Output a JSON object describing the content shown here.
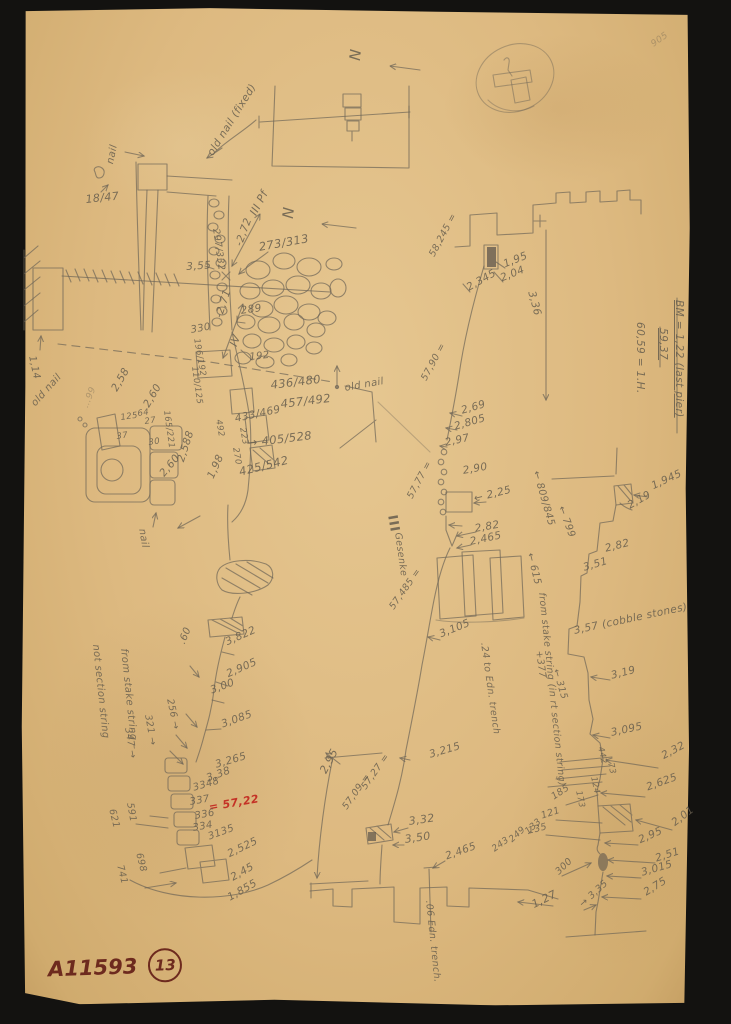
{
  "scan": {
    "catalog_number": "A11593",
    "plate_number": "13"
  },
  "colors": {
    "background": "#131210",
    "paper": "#ddb980",
    "pencil": "#6e6557",
    "red_note": "#c32b22",
    "ink": "#6d2a1e"
  },
  "annotations": [
    {
      "t": "N",
      "x": 362,
      "y": 50,
      "r": 96,
      "s": 15,
      "n": "north-letter"
    },
    {
      "t": "old nail (fixed)",
      "x": 206,
      "y": 152,
      "r": -58,
      "s": 10.5,
      "n": "old-nail-note"
    },
    {
      "t": "nail",
      "x": 106,
      "y": 163,
      "r": -78,
      "s": 10
    },
    {
      "t": "18/47",
      "x": 85,
      "y": 194,
      "r": -6,
      "s": 11
    },
    {
      "t": "N",
      "x": 295,
      "y": 208,
      "r": 96,
      "s": 15,
      "n": "north-letter"
    },
    {
      "t": "III Pf",
      "x": 248,
      "y": 212,
      "r": -62,
      "s": 11,
      "n": "pier-label"
    },
    {
      "t": "-2,72",
      "x": 234,
      "y": 244,
      "r": -70,
      "s": 10.5
    },
    {
      "t": "297/332",
      "x": 220,
      "y": 228,
      "r": 82,
      "s": 9.5
    },
    {
      "t": "3,55",
      "x": 186,
      "y": 262,
      "r": -4,
      "s": 10.5
    },
    {
      "t": "273/313",
      "x": 258,
      "y": 242,
      "r": -10,
      "s": 11.5
    },
    {
      "t": "289",
      "x": 240,
      "y": 306,
      "r": -8,
      "s": 10.5
    },
    {
      "t": "-2,71",
      "x": 214,
      "y": 316,
      "r": -72,
      "s": 10.5
    },
    {
      "t": "IV",
      "x": 228,
      "y": 344,
      "r": -70,
      "s": 11
    },
    {
      "t": "330",
      "x": 190,
      "y": 326,
      "r": -10,
      "s": 10
    },
    {
      "t": "192",
      "x": 249,
      "y": 353,
      "r": -6,
      "s": 10
    },
    {
      "t": "196/192",
      "x": 200,
      "y": 338,
      "r": 80,
      "s": 8.5
    },
    {
      "t": "110/125",
      "x": 198,
      "y": 366,
      "r": 82,
      "s": 8.5
    },
    {
      "t": "165/221",
      "x": 170,
      "y": 410,
      "r": 82,
      "s": 8.5
    },
    {
      "t": "436/480",
      "x": 270,
      "y": 380,
      "r": -7,
      "s": 11.5
    },
    {
      "t": "457/492",
      "x": 280,
      "y": 399,
      "r": -7,
      "s": 11.5
    },
    {
      "t": "433/469",
      "x": 234,
      "y": 414,
      "r": -12,
      "s": 10.5
    },
    {
      "t": "492",
      "x": 222,
      "y": 419,
      "r": 80,
      "s": 8.5
    },
    {
      "t": "223",
      "x": 246,
      "y": 427,
      "r": 80,
      "s": 8.5
    },
    {
      "t": "→ 405/528",
      "x": 247,
      "y": 438,
      "r": -7,
      "s": 11.5
    },
    {
      "t": "270",
      "x": 239,
      "y": 447,
      "r": 80,
      "s": 8.5
    },
    {
      "t": "425/542",
      "x": 238,
      "y": 467,
      "r": -14,
      "s": 11.5
    },
    {
      "t": "old nail",
      "x": 344,
      "y": 384,
      "r": -10,
      "s": 10,
      "n": "old-nail-note"
    },
    {
      "t": "1,14",
      "x": 36,
      "y": 355,
      "r": 78,
      "s": 10
    },
    {
      "t": "old nail",
      "x": 30,
      "y": 402,
      "r": -48,
      "s": 10,
      "n": "old-nail-note"
    },
    {
      "t": "…99",
      "x": 82,
      "y": 406,
      "r": -68,
      "s": 9,
      "c": "faint",
      "n": "oval-note"
    },
    {
      "t": "2,58",
      "x": 110,
      "y": 388,
      "r": -60,
      "s": 10.5
    },
    {
      "t": "2,60",
      "x": 142,
      "y": 404,
      "r": -60,
      "s": 10.5
    },
    {
      "t": "125",
      "x": 120,
      "y": 414,
      "r": -8,
      "s": 8.5
    },
    {
      "t": "64",
      "x": 137,
      "y": 410,
      "r": -8,
      "s": 8.5
    },
    {
      "t": "27",
      "x": 144,
      "y": 418,
      "r": -8,
      "s": 8.5
    },
    {
      "t": "37",
      "x": 116,
      "y": 433,
      "r": -8,
      "s": 8.5
    },
    {
      "t": "30",
      "x": 148,
      "y": 439,
      "r": -8,
      "s": 8.5
    },
    {
      "t": "2,60",
      "x": 158,
      "y": 472,
      "r": -50,
      "s": 10.5
    },
    {
      "t": "2,588",
      "x": 176,
      "y": 460,
      "r": -72,
      "s": 10.5
    },
    {
      "t": "1,98",
      "x": 206,
      "y": 476,
      "r": -66,
      "s": 10.5
    },
    {
      "t": "nail",
      "x": 146,
      "y": 528,
      "r": 80,
      "s": 10
    },
    {
      "t": "58,245 =",
      "x": 428,
      "y": 254,
      "r": -62,
      "s": 9.5,
      "n": "elevation-note"
    },
    {
      "t": "1,95",
      "x": 502,
      "y": 260,
      "r": -22,
      "s": 10.5
    },
    {
      "t": "2,04",
      "x": 499,
      "y": 274,
      "r": -22,
      "s": 10.5
    },
    {
      "t": "2,345",
      "x": 465,
      "y": 284,
      "r": -30,
      "s": 10.5
    },
    {
      "t": "3,36",
      "x": 536,
      "y": 290,
      "r": 75,
      "s": 10.5
    },
    {
      "t": "BM = 1,22 (last pier)",
      "x": 684,
      "y": 300,
      "r": 90,
      "s": 10.5,
      "u": true,
      "n": "benchmark-note"
    },
    {
      "t": "59,37",
      "x": 668,
      "y": 328,
      "r": 90,
      "s": 10.5,
      "u": true,
      "n": "benchmark-elevation"
    },
    {
      "t": "60,59 = 1.H.",
      "x": 645,
      "y": 322,
      "r": 90,
      "s": 10.5,
      "n": "benchmark-sum"
    },
    {
      "t": "57,90 =",
      "x": 420,
      "y": 378,
      "r": -62,
      "s": 9.5,
      "n": "elevation-note"
    },
    {
      "t": "2,69",
      "x": 460,
      "y": 406,
      "r": -16,
      "s": 10.5
    },
    {
      "t": "2,805",
      "x": 453,
      "y": 422,
      "r": -16,
      "s": 10.5
    },
    {
      "t": "2,97",
      "x": 444,
      "y": 438,
      "r": -12,
      "s": 10.5
    },
    {
      "t": "2,90",
      "x": 462,
      "y": 466,
      "r": -10,
      "s": 10.5
    },
    {
      "t": "← 2,25",
      "x": 473,
      "y": 494,
      "r": -14,
      "s": 10.5
    },
    {
      "t": "2,82",
      "x": 474,
      "y": 524,
      "r": -10,
      "s": 10.5
    },
    {
      "t": "2,465",
      "x": 469,
      "y": 537,
      "r": -12,
      "s": 10.5
    },
    {
      "t": "57,77 =",
      "x": 406,
      "y": 496,
      "r": -62,
      "s": 9.5,
      "n": "elevation-note"
    },
    {
      "t": "III",
      "x": 398,
      "y": 514,
      "r": 80,
      "s": 13,
      "b": true
    },
    {
      "t": "Gesenke",
      "x": 402,
      "y": 532,
      "r": 82,
      "s": 9.5
    },
    {
      "t": "57,485 =",
      "x": 388,
      "y": 606,
      "r": -55,
      "s": 9.5,
      "n": "elevation-note"
    },
    {
      "t": "3,105",
      "x": 438,
      "y": 630,
      "r": -22,
      "s": 10.5
    },
    {
      "t": "← 809/845",
      "x": 540,
      "y": 470,
      "r": 74,
      "s": 10
    },
    {
      "t": "← 799",
      "x": 565,
      "y": 505,
      "r": 70,
      "s": 10
    },
    {
      "t": "← 615",
      "x": 534,
      "y": 552,
      "r": 76,
      "s": 10
    },
    {
      "t": "from stake string (in rt section string)",
      "x": 546,
      "y": 592,
      "r": 84,
      "s": 9.5,
      "n": "stake-string-note"
    },
    {
      "t": "+377",
      "x": 543,
      "y": 650,
      "r": 82,
      "s": 9.5
    },
    {
      "t": "← 315",
      "x": 560,
      "y": 668,
      "r": 74,
      "s": 9.5
    },
    {
      "t": ".24 to Edn. trench",
      "x": 488,
      "y": 642,
      "r": 82,
      "s": 9.5,
      "n": "trench-note"
    },
    {
      "t": "3,215",
      "x": 428,
      "y": 750,
      "r": -16,
      "s": 10.5
    },
    {
      "t": "1,945",
      "x": 650,
      "y": 482,
      "r": -25,
      "s": 10.5
    },
    {
      "t": "2,19",
      "x": 626,
      "y": 502,
      "r": -30,
      "s": 10.5
    },
    {
      "t": "2,82",
      "x": 604,
      "y": 544,
      "r": -14,
      "s": 10.5
    },
    {
      "t": "3,51",
      "x": 582,
      "y": 563,
      "r": -16,
      "s": 10.5
    },
    {
      "t": "3,57 (cobble stones)",
      "x": 573,
      "y": 626,
      "r": -12,
      "s": 10.5,
      "n": "cobble-note"
    },
    {
      "t": "3,19",
      "x": 610,
      "y": 671,
      "r": -14,
      "s": 10.5
    },
    {
      "t": "3,095",
      "x": 610,
      "y": 728,
      "r": -12,
      "s": 10.5
    },
    {
      "t": "2,32",
      "x": 660,
      "y": 752,
      "r": -28,
      "s": 10.5
    },
    {
      "t": "442",
      "x": 604,
      "y": 746,
      "r": 78,
      "s": 8.5
    },
    {
      "t": "73",
      "x": 614,
      "y": 762,
      "r": 78,
      "s": 8.5
    },
    {
      "t": "124",
      "x": 597,
      "y": 776,
      "r": 78,
      "s": 8.5
    },
    {
      "t": "173",
      "x": 582,
      "y": 790,
      "r": 78,
      "s": 8.5
    },
    {
      "t": "2,625",
      "x": 645,
      "y": 783,
      "r": -20,
      "s": 10.5
    },
    {
      "t": "185",
      "x": 550,
      "y": 794,
      "r": -34,
      "s": 9.5
    },
    {
      "t": "121",
      "x": 540,
      "y": 812,
      "r": -18,
      "s": 9.5
    },
    {
      "t": "135",
      "x": 527,
      "y": 827,
      "r": -14,
      "s": 9.5
    },
    {
      "t": "2,01",
      "x": 670,
      "y": 820,
      "r": -38,
      "s": 10.5
    },
    {
      "t": "2,95",
      "x": 637,
      "y": 836,
      "r": -24,
      "s": 10.5
    },
    {
      "t": "2,51",
      "x": 654,
      "y": 854,
      "r": -18,
      "s": 10.5
    },
    {
      "t": "3,015",
      "x": 640,
      "y": 868,
      "r": -16,
      "s": 10.5
    },
    {
      "t": "2,75",
      "x": 642,
      "y": 889,
      "r": -32,
      "s": 10.5
    },
    {
      "t": "→ 3,35",
      "x": 578,
      "y": 902,
      "r": -42,
      "s": 9.5
    },
    {
      "t": "300",
      "x": 554,
      "y": 870,
      "r": -44,
      "s": 9.5
    },
    {
      "t": "1,27",
      "x": 530,
      "y": 900,
      "r": -26,
      "s": 11
    },
    {
      "t": "2,95",
      "x": 318,
      "y": 770,
      "r": -62,
      "s": 11
    },
    {
      "t": "57,27 =",
      "x": 360,
      "y": 786,
      "r": -55,
      "s": 9.5,
      "n": "elevation-note"
    },
    {
      "t": "57,09 =",
      "x": 341,
      "y": 806,
      "r": -55,
      "s": 9.5,
      "n": "elevation-note"
    },
    {
      "t": "3,32",
      "x": 408,
      "y": 816,
      "r": -8,
      "s": 11
    },
    {
      "t": "3,50",
      "x": 404,
      "y": 834,
      "r": -8,
      "s": 11
    },
    {
      "t": "2,465",
      "x": 444,
      "y": 852,
      "r": -20,
      "s": 10.5
    },
    {
      "t": "133",
      "x": 524,
      "y": 830,
      "r": -42,
      "s": 9
    },
    {
      "t": "249",
      "x": 508,
      "y": 838,
      "r": -42,
      "s": 9
    },
    {
      "t": "243",
      "x": 491,
      "y": 847,
      "r": -36,
      "s": 9
    },
    {
      "t": ".06 Edn. trench.",
      "x": 433,
      "y": 900,
      "r": 84,
      "s": 9.5,
      "n": "trench-note"
    },
    {
      "t": "from stake string –",
      "x": 128,
      "y": 648,
      "r": 84,
      "s": 10,
      "n": "stake-string-note"
    },
    {
      "t": "not section string",
      "x": 100,
      "y": 644,
      "r": 84,
      "s": 10,
      "n": "stake-string-note"
    },
    {
      "t": ".60",
      "x": 178,
      "y": 642,
      "r": -68,
      "s": 10
    },
    {
      "t": "3,822",
      "x": 224,
      "y": 638,
      "r": -24,
      "s": 10.5
    },
    {
      "t": "2,905",
      "x": 225,
      "y": 670,
      "r": -24,
      "s": 10.5
    },
    {
      "t": "3,00",
      "x": 209,
      "y": 686,
      "r": -20,
      "s": 10.5
    },
    {
      "t": "256 →",
      "x": 174,
      "y": 698,
      "r": 78,
      "s": 9.5
    },
    {
      "t": "321 →",
      "x": 152,
      "y": 714,
      "r": 80,
      "s": 9.5
    },
    {
      "t": "347 →",
      "x": 132,
      "y": 727,
      "r": 80,
      "s": 9.5
    },
    {
      "t": "3,085",
      "x": 220,
      "y": 720,
      "r": -20,
      "s": 10.5
    },
    {
      "t": "3,265",
      "x": 214,
      "y": 760,
      "r": -16,
      "s": 10.5
    },
    {
      "t": "3,38",
      "x": 205,
      "y": 774,
      "r": -20,
      "s": 10.5
    },
    {
      "t": "3348",
      "x": 192,
      "y": 784,
      "r": -16,
      "s": 10
    },
    {
      "t": "337",
      "x": 189,
      "y": 798,
      "r": -10,
      "s": 10
    },
    {
      "t": "= 57,22",
      "x": 208,
      "y": 802,
      "r": -10,
      "s": 11,
      "c": "red",
      "n": "red-elevation"
    },
    {
      "t": "336",
      "x": 194,
      "y": 812,
      "r": -10,
      "s": 10
    },
    {
      "t": "334",
      "x": 192,
      "y": 824,
      "r": -10,
      "s": 10
    },
    {
      "t": "3135",
      "x": 207,
      "y": 833,
      "r": -20,
      "s": 10
    },
    {
      "t": "2,525",
      "x": 226,
      "y": 850,
      "r": -26,
      "s": 10.5
    },
    {
      "t": "2,45",
      "x": 229,
      "y": 874,
      "r": -30,
      "s": 10.5
    },
    {
      "t": "1,855",
      "x": 226,
      "y": 894,
      "r": -30,
      "s": 10.5
    },
    {
      "t": "591",
      "x": 134,
      "y": 802,
      "r": 80,
      "s": 9.5
    },
    {
      "t": "621",
      "x": 116,
      "y": 808,
      "r": 76,
      "s": 9.5
    },
    {
      "t": "698",
      "x": 143,
      "y": 852,
      "r": 76,
      "s": 9.5
    },
    {
      "t": "741",
      "x": 124,
      "y": 864,
      "r": 76,
      "s": 9.5
    },
    {
      "t": "905",
      "x": 650,
      "y": 42,
      "r": -35,
      "s": 9,
      "c": "faint",
      "n": "faint-corner-number"
    }
  ]
}
